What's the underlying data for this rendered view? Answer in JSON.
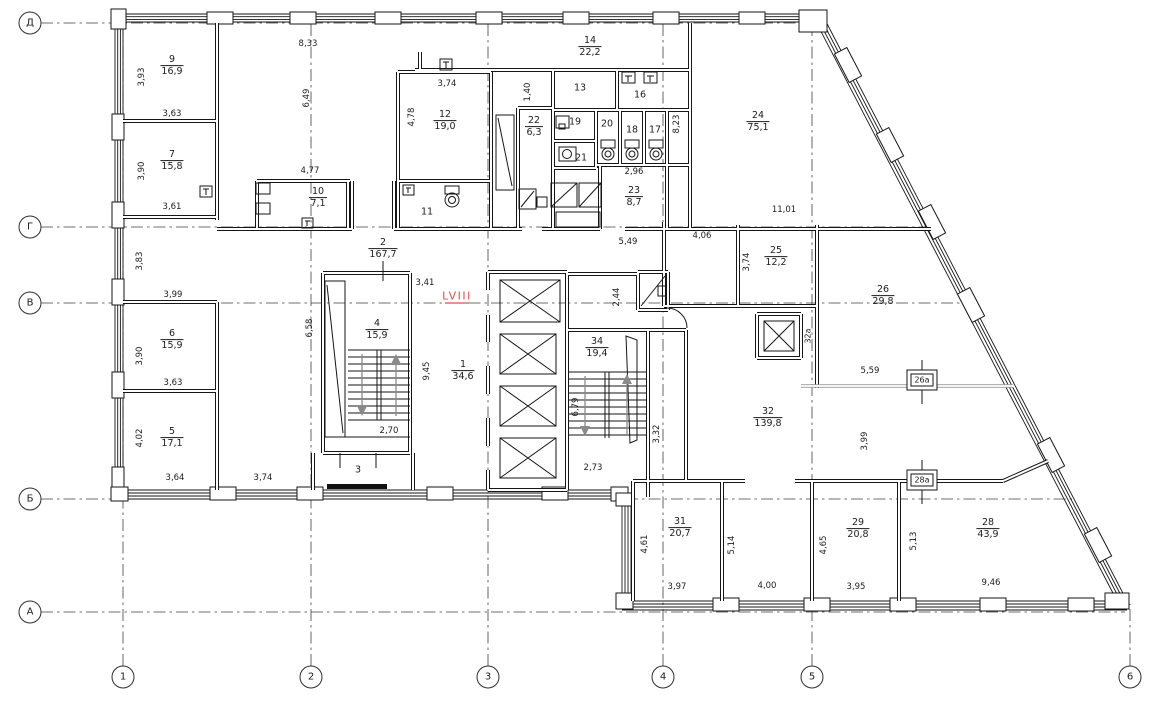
{
  "drawing_type": "floor-plan",
  "accent_color": "#d85050",
  "line_color": "#1c1c1c",
  "unit": {
    "text": "LVIII",
    "x": 457,
    "y": 296,
    "color": "#d85050"
  },
  "axes": {
    "rows": [
      {
        "label": "Д",
        "y": 23
      },
      {
        "label": "Г",
        "y": 227
      },
      {
        "label": "В",
        "y": 303
      },
      {
        "label": "Б",
        "y": 499
      },
      {
        "label": "А",
        "y": 612
      }
    ],
    "cols": [
      {
        "label": "1",
        "x": 123
      },
      {
        "label": "2",
        "x": 311
      },
      {
        "label": "3",
        "x": 488
      },
      {
        "label": "4",
        "x": 663
      },
      {
        "label": "5",
        "x": 812
      },
      {
        "label": "6",
        "x": 1130
      }
    ]
  },
  "rooms": [
    {
      "num": "9",
      "area": "16,9",
      "x": 172,
      "y": 66
    },
    {
      "num": "7",
      "area": "15,8",
      "x": 172,
      "y": 161
    },
    {
      "num": "6",
      "area": "15,9",
      "x": 172,
      "y": 340
    },
    {
      "num": "5",
      "area": "17,1",
      "x": 172,
      "y": 438
    },
    {
      "num": "10",
      "area": "7,1",
      "x": 318,
      "y": 198
    },
    {
      "num": "12",
      "area": "19,0",
      "x": 445,
      "y": 121
    },
    {
      "num": "14",
      "area": "22,2",
      "x": 590,
      "y": 47
    },
    {
      "num": "22",
      "area": "6,3",
      "x": 534,
      "y": 127
    },
    {
      "num": "23",
      "area": "8,7",
      "x": 634,
      "y": 197
    },
    {
      "num": "24",
      "area": "75,1",
      "x": 758,
      "y": 122
    },
    {
      "num": "2",
      "area": "167,7",
      "x": 383,
      "y": 249
    },
    {
      "num": "4",
      "area": "15,9",
      "x": 377,
      "y": 330
    },
    {
      "num": "1",
      "area": "34,6",
      "x": 463,
      "y": 371
    },
    {
      "num": "34",
      "area": "19,4",
      "x": 597,
      "y": 348
    },
    {
      "num": "25",
      "area": "12,2",
      "x": 776,
      "y": 257
    },
    {
      "num": "26",
      "area": "29,8",
      "x": 883,
      "y": 296
    },
    {
      "num": "32",
      "area": "139,8",
      "x": 768,
      "y": 418
    },
    {
      "num": "31",
      "area": "20,7",
      "x": 680,
      "y": 528
    },
    {
      "num": "29",
      "area": "20,8",
      "x": 858,
      "y": 529
    },
    {
      "num": "28",
      "area": "43,9",
      "x": 988,
      "y": 529
    },
    {
      "num": "13",
      "x": 580,
      "y": 88
    },
    {
      "num": "16",
      "x": 640,
      "y": 95
    },
    {
      "num": "19",
      "x": 575,
      "y": 122
    },
    {
      "num": "20",
      "x": 607,
      "y": 124
    },
    {
      "num": "18",
      "x": 632,
      "y": 130
    },
    {
      "num": "17",
      "x": 655,
      "y": 130
    },
    {
      "num": "21",
      "x": 581,
      "y": 158
    },
    {
      "num": "11",
      "x": 427,
      "y": 212
    },
    {
      "num": "3",
      "x": 358,
      "y": 470
    }
  ],
  "shafts": [
    {
      "text": "32а",
      "x": 808,
      "y": 336,
      "rot": 1
    },
    {
      "text": "26а",
      "x": 922,
      "y": 380
    },
    {
      "text": "28а",
      "x": 922,
      "y": 480
    }
  ],
  "dims": [
    {
      "t": "8,33",
      "x": 308,
      "y": 44
    },
    {
      "t": "6,49",
      "x": 307,
      "y": 98,
      "r": 1
    },
    {
      "t": "4,77",
      "x": 310,
      "y": 171
    },
    {
      "t": "3,93",
      "x": 142,
      "y": 77,
      "r": 1
    },
    {
      "t": "3,63",
      "x": 172,
      "y": 114
    },
    {
      "t": "3,90",
      "x": 142,
      "y": 171,
      "r": 1
    },
    {
      "t": "3,61",
      "x": 172,
      "y": 207
    },
    {
      "t": "3,74",
      "x": 447,
      "y": 84
    },
    {
      "t": "4,78",
      "x": 412,
      "y": 117,
      "r": 1
    },
    {
      "t": "1,40",
      "x": 528,
      "y": 92,
      "r": 1
    },
    {
      "t": "8,23",
      "x": 677,
      "y": 124,
      "r": 1
    },
    {
      "t": "2,96",
      "x": 634,
      "y": 172
    },
    {
      "t": "5,49",
      "x": 628,
      "y": 242
    },
    {
      "t": "4,06",
      "x": 702,
      "y": 236
    },
    {
      "t": "11,01",
      "x": 784,
      "y": 210
    },
    {
      "t": "3,74",
      "x": 747,
      "y": 262,
      "r": 1
    },
    {
      "t": "3,41",
      "x": 425,
      "y": 283
    },
    {
      "t": "2,44",
      "x": 617,
      "y": 297,
      "r": 1
    },
    {
      "t": "3,83",
      "x": 140,
      "y": 261,
      "r": 1
    },
    {
      "t": "3,99",
      "x": 173,
      "y": 295
    },
    {
      "t": "6,58",
      "x": 310,
      "y": 328,
      "r": 1
    },
    {
      "t": "3,90",
      "x": 140,
      "y": 356,
      "r": 1
    },
    {
      "t": "3,63",
      "x": 173,
      "y": 383
    },
    {
      "t": "4,02",
      "x": 140,
      "y": 438,
      "r": 1
    },
    {
      "t": "3,64",
      "x": 175,
      "y": 478
    },
    {
      "t": "3,74",
      "x": 263,
      "y": 478
    },
    {
      "t": "9,45",
      "x": 427,
      "y": 371,
      "r": 1
    },
    {
      "t": "2,70",
      "x": 389,
      "y": 431
    },
    {
      "t": "2,73",
      "x": 593,
      "y": 468
    },
    {
      "t": "6,79",
      "x": 576,
      "y": 407,
      "r": 1
    },
    {
      "t": "3,32",
      "x": 657,
      "y": 434,
      "r": 1
    },
    {
      "t": "5,59",
      "x": 870,
      "y": 371
    },
    {
      "t": "3,99",
      "x": 865,
      "y": 441,
      "r": 1
    },
    {
      "t": "4,61",
      "x": 645,
      "y": 544,
      "r": 1
    },
    {
      "t": "5,14",
      "x": 732,
      "y": 545,
      "r": 1
    },
    {
      "t": "4,65",
      "x": 824,
      "y": 545,
      "r": 1
    },
    {
      "t": "5,13",
      "x": 914,
      "y": 541,
      "r": 1
    },
    {
      "t": "3,97",
      "x": 677,
      "y": 587
    },
    {
      "t": "4,00",
      "x": 767,
      "y": 586
    },
    {
      "t": "3,95",
      "x": 856,
      "y": 587
    },
    {
      "t": "9,46",
      "x": 991,
      "y": 583
    }
  ]
}
